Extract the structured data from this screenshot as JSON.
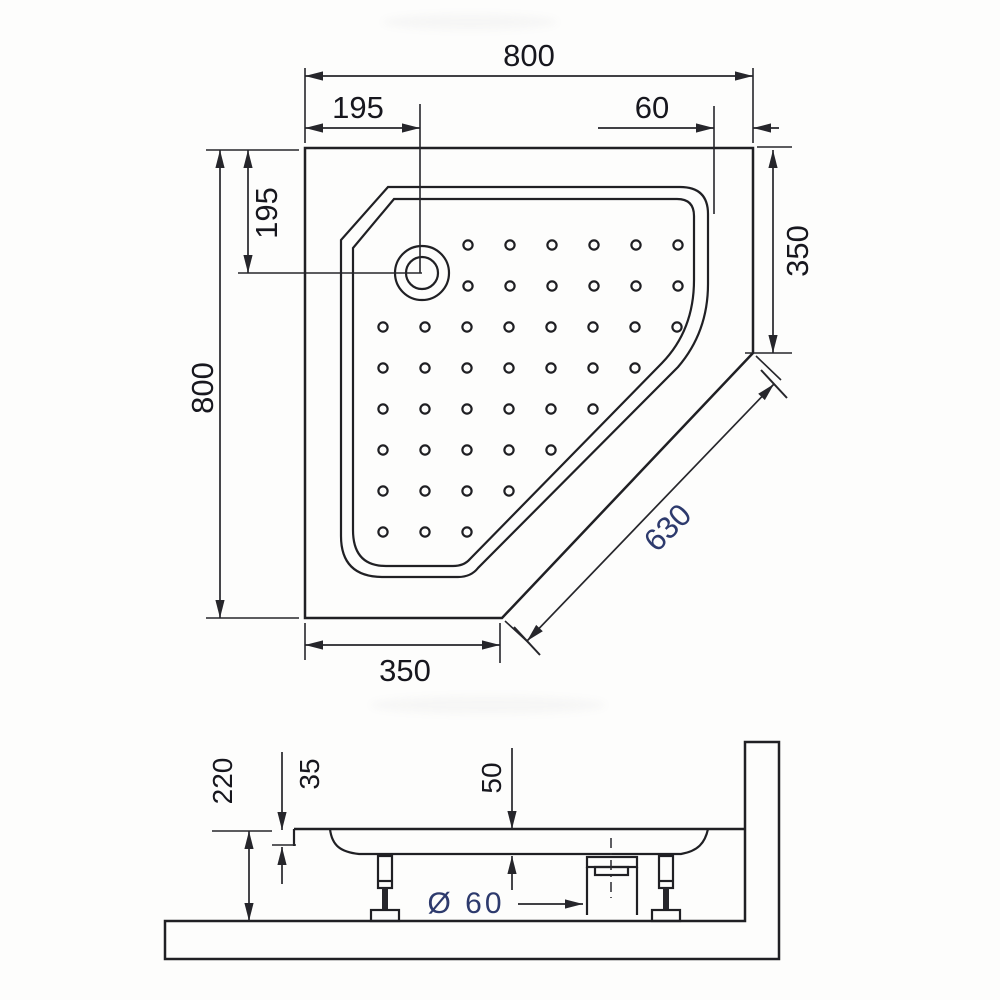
{
  "meta": {
    "type": "technical dimension drawing",
    "subject": "corner pentagonal shower tray",
    "views": [
      "plan view (top)",
      "side section view"
    ]
  },
  "plan_view": {
    "overall_width": "800",
    "overall_height": "800",
    "drain_offset_from_top": "195",
    "drain_offset_from_left": "195",
    "rim_to_right_edge": "60",
    "right_edge_to_cut": "350",
    "diagonal_cut_length": "630",
    "bottom_edge_to_cut": "350"
  },
  "side_view": {
    "total_height": "220",
    "rim_drop": "35",
    "basin_depth": "50",
    "drain_diameter": "Ø 60"
  },
  "colors": {
    "line": "#202024",
    "text": "#17171e",
    "accent_text": "#2d3a6d",
    "background": "#fdfdfc"
  }
}
